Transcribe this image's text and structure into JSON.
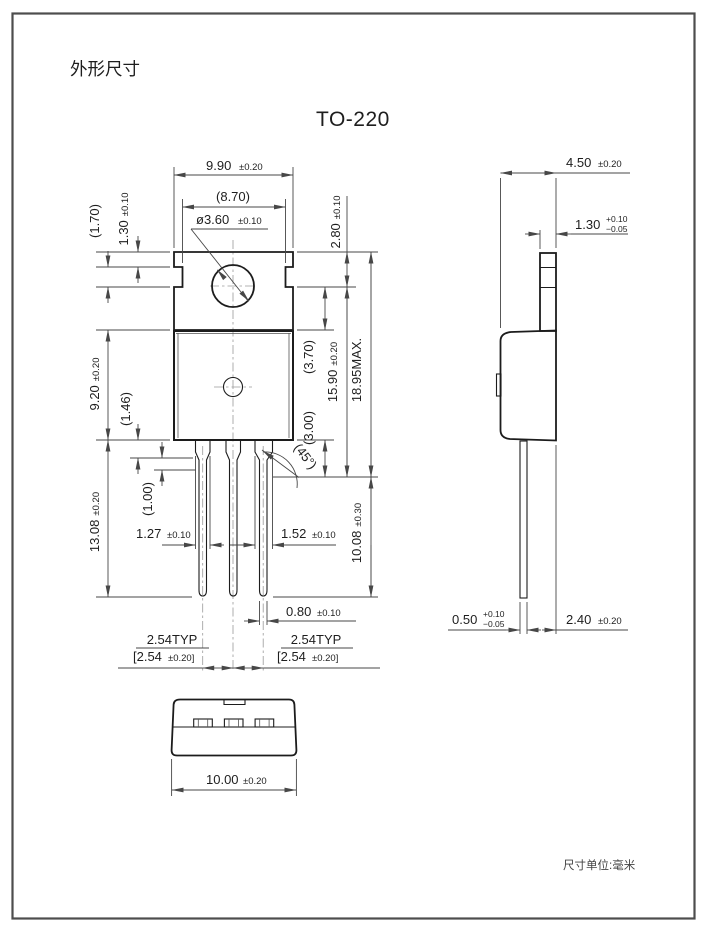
{
  "page": {
    "title": "外形尺寸",
    "package_name": "TO-220",
    "units_note": "尺寸单位:毫米"
  },
  "dims": {
    "front": {
      "body_width": {
        "v": "9.90",
        "t": "±0.20"
      },
      "tab_width_inner": {
        "v": "(8.70)"
      },
      "hole_dia": {
        "v": "ø3.60",
        "t": "±0.10"
      },
      "tab_top_to_hole": {
        "v": "2.80",
        "t": "±0.10"
      },
      "notch_height": {
        "v": "(1.70)"
      },
      "tab_top_to_notch": {
        "v": "1.30",
        "t": "±0.10"
      },
      "body_height": {
        "v": "9.20",
        "t": "±0.20"
      },
      "shoulder_len": {
        "v": "(1.46)"
      },
      "lead_len": {
        "v": "13.08",
        "t": "±0.20"
      },
      "taper_len": {
        "v": "(1.00)"
      },
      "lead_width_1": {
        "v": "1.27",
        "t": "±0.10"
      },
      "lead_width_2": {
        "v": "1.52",
        "t": "±0.10"
      },
      "tab_height": {
        "v": "(3.70)"
      },
      "below_body": {
        "v": "(3.00)"
      },
      "hole_to_shoulder": {
        "v": "15.90",
        "t": "±0.20"
      },
      "total_height": {
        "v": "18.95MAX."
      },
      "lead_below": {
        "v": "10.08",
        "t": "±0.30"
      },
      "chamfer_angle": {
        "v": "(45°)"
      },
      "lead_thickness": {
        "v": "0.80",
        "t": "±0.10"
      },
      "pitch_typ": {
        "v": "2.54TYP"
      },
      "pitch_bracket": {
        "v": "[2.54",
        "t": "±0.20]"
      }
    },
    "side": {
      "depth": {
        "v": "4.50",
        "t": "±0.20"
      },
      "tab_thickness": {
        "v": "1.30",
        "tp": "+0.10",
        "tm": "−0.05"
      },
      "lead_thickness": {
        "v": "0.50",
        "tp": "+0.10",
        "tm": "−0.05"
      },
      "lead_offset": {
        "v": "2.40",
        "t": "±0.20"
      }
    },
    "bottom": {
      "width": {
        "v": "10.00",
        "t": "±0.20"
      }
    }
  }
}
